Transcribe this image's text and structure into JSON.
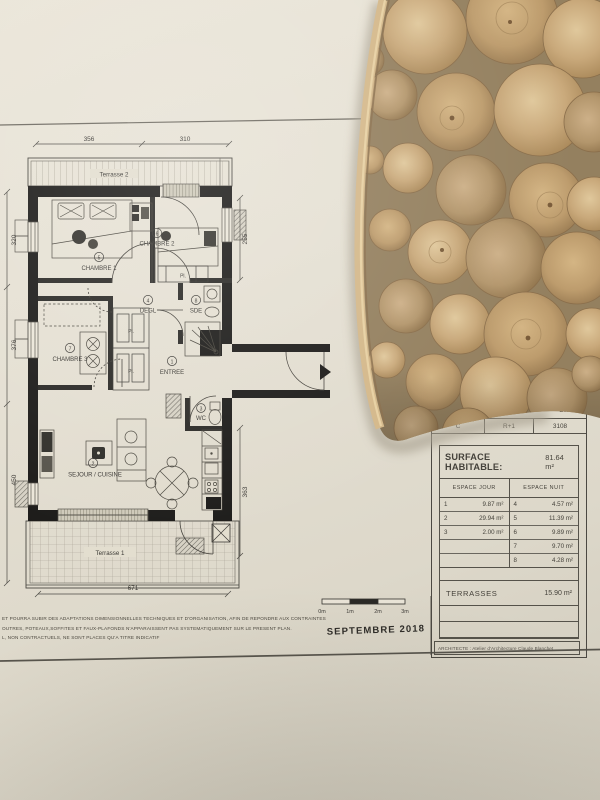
{
  "plan": {
    "terrasse2": "Terrasse 2",
    "terrasse1": "Terrasse 1",
    "pl": "Pl.",
    "rooms": {
      "chambre1": {
        "n": "5",
        "label": "CHAMBRE 1"
      },
      "chambre2": {
        "n": "6",
        "label": "CHAMBRE 2"
      },
      "chambre3": {
        "n": "7",
        "label": "CHAMBRE 3"
      },
      "degl": {
        "n": "4",
        "label": "DEGL"
      },
      "sde": {
        "n": "8",
        "label": "SDE"
      },
      "entree": {
        "n": "1",
        "label": "ENTREE"
      },
      "wc": {
        "n": "3",
        "label": "WC"
      },
      "sejour": {
        "n": "2",
        "label": "SEJOUR / CUISINE"
      }
    },
    "dims": {
      "top1": "356",
      "top2": "310",
      "right1": "255",
      "right2": "363",
      "left1": "320",
      "left2": "376",
      "left3": "450",
      "bottom": "671"
    }
  },
  "scalebar": {
    "m0": "0m",
    "m1": "1m",
    "m2": "2m",
    "m3": "3m"
  },
  "date": "SEPTEMBRE 2018",
  "fine_print": {
    "l1": "ET POURRA SUBIR DES ADAPTATIONS DIMENSIONNELLES TECHNIQUES ET D'ORGANISATION, AFIN DE REPONDRE AUX CONTRAINTES",
    "l2": "OUTRES, POTEAUX,SOFFITES ET FAUX-PLAFONDS N'APPARAISSENT PAS SYSTEMATIQUEMENT SUR LE PRESENT PLAN.",
    "l3": "L, NON CONTRACTUELS, NE SONT PLACES QU'A TITRE INDICATIF"
  },
  "title_block": {
    "header_partial": "EMENT",
    "col1": "C",
    "col2": "R+1",
    "col3": "3108",
    "surface_label": "SURFACE HABITABLE:",
    "surface_value": "81.64 m²",
    "jour_header": "ESPACE JOUR",
    "nuit_header": "ESPACE NUIT",
    "jour": [
      [
        "1",
        "9.87 m²"
      ],
      [
        "2",
        "29.94 m²"
      ],
      [
        "3",
        "2.00 m²"
      ],
      [
        "",
        ""
      ],
      [
        "",
        ""
      ]
    ],
    "nuit": [
      [
        "4",
        "4.57 m²"
      ],
      [
        "5",
        "11.39 m²"
      ],
      [
        "6",
        "9.89 m²"
      ],
      [
        "7",
        "9.70 m²"
      ],
      [
        "8",
        "4.28 m²"
      ]
    ],
    "terrasses_label": "TERRASSES",
    "terrasses_value": "15.90 m²",
    "architect": "ARCHITECTE : Atelier d'Architecture Claude Blanchet"
  },
  "colors": {
    "paper": "#e4dfd2",
    "ink": "#3c3a36",
    "wall": "#1d1c1a",
    "wood": "#c9a97b"
  }
}
